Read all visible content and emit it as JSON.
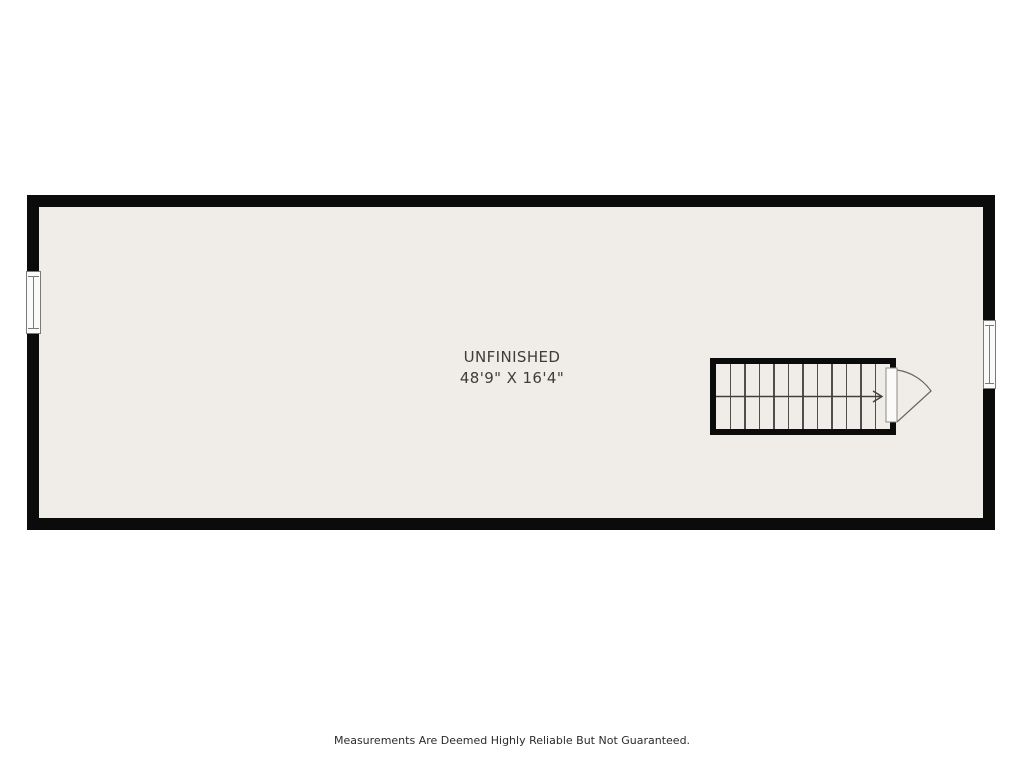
{
  "page": {
    "background": "#ffffff",
    "footer": {
      "disclaimer": "Measurements Are Deemed Highly Reliable But Not Guaranteed."
    }
  },
  "floorplan": {
    "room": {
      "label": "UNFINISHED",
      "dimensions": "48'9\" X 16'4\""
    },
    "staircase": {
      "tread_count": 12,
      "direction": "right"
    },
    "windows": [
      {
        "wall": "left"
      },
      {
        "wall": "right"
      }
    ],
    "colors": {
      "wall": "#0b0b0b",
      "floor": "#f0ede8",
      "tread_line": "#4f4f4f",
      "arrow": "#3f3f3f",
      "window_frame": "#7a7a7a",
      "window_fill": "#fbfaf8",
      "door_swing": "#666666",
      "label_text": "#3d3d3d",
      "footer_text": "#2b2b2b"
    }
  }
}
